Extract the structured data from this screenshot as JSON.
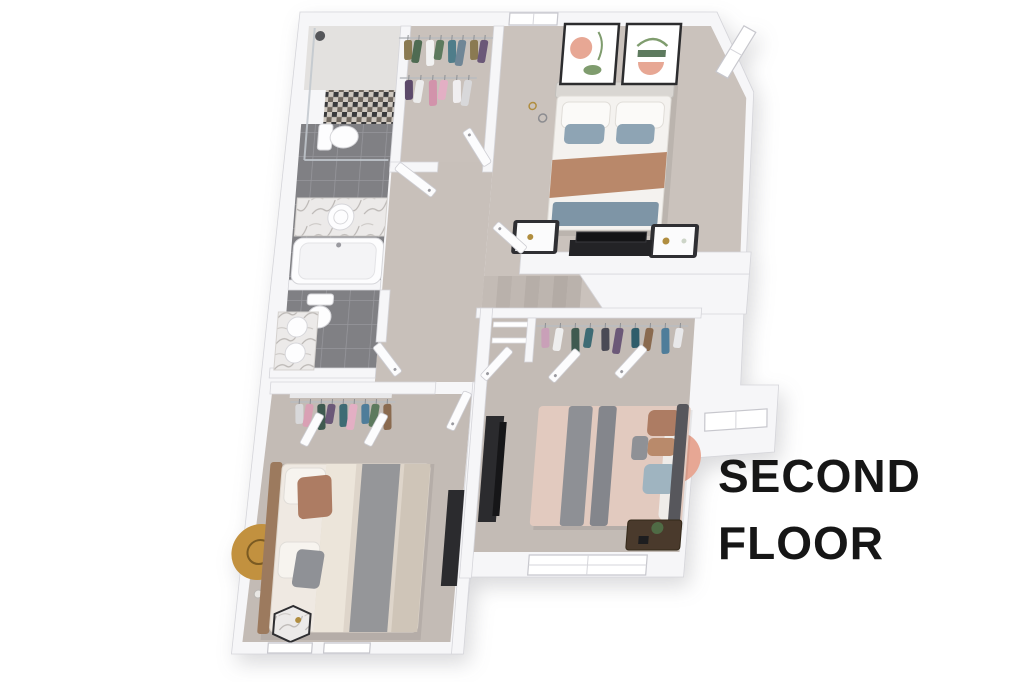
{
  "title": {
    "line1": "SECOND",
    "line2": "FLOOR",
    "color": "#161616"
  },
  "palette": {
    "background": "#ffffff",
    "wall": "#f6f6f8",
    "wall_edge": "#d5d5da",
    "carpet_master": "#cac2bc",
    "carpet_hall": "#c8c0ba",
    "carpet_bedroom": "#c3bbb5",
    "carpet_closet": "#c9c1bb",
    "tile_grey": "#808084",
    "mosaic_dark": "#39393b",
    "marble": "#eceae9",
    "dark_furniture": "#2b2b2e",
    "wood": "#4a3a2c",
    "gold": "#b08d3f",
    "rug_gold": "#c2913f",
    "rug_pink": "#e7a794",
    "rug_green": "#42594a",
    "bed_blue_pillow": "#8ea4b4",
    "bed_tan_throw": "#b9886a",
    "bed_slate_bench": "#7e95a6",
    "bed_pink_duvet": "#e2cabf",
    "bed_grey_throw": "#8e9095",
    "bed_brown_pillow": "#ad7c63",
    "headboard_grey": "#57575c"
  },
  "rooms": [
    {
      "id": "primary-bedroom",
      "contents": [
        "double-bed",
        "nightstand-left",
        "nightstand-right",
        "wall-art-1",
        "wall-art-2",
        "tv-on-half-wall",
        "pendant-lights"
      ],
      "windows": 2
    },
    {
      "id": "primary-walk-in-closet",
      "contents": [
        "clothes-rail-upper",
        "clothes-rail-lower"
      ]
    },
    {
      "id": "primary-bathroom",
      "contents": [
        "walk-in-shower",
        "toilet",
        "vanity-sink",
        "bathtub"
      ]
    },
    {
      "id": "second-bathroom",
      "contents": [
        "toilet",
        "double-vanity"
      ]
    },
    {
      "id": "hallway",
      "contents": [
        "staircase"
      ]
    },
    {
      "id": "middle-bedroom",
      "contents": [
        "double-bed",
        "tv-cabinet",
        "wood-nightstand-with-plant",
        "round-rug",
        "closet-with-shelves-and-rail"
      ],
      "windows": 2
    },
    {
      "id": "left-bedroom",
      "contents": [
        "double-bed",
        "hexagon-marble-side-table",
        "floor-lamp",
        "round-gold-rug",
        "media-unit",
        "closet-rail"
      ],
      "windows": 2
    }
  ],
  "closets": {
    "master_rail_1": {
      "colors": [
        "#8a7a52",
        "#4f6b52",
        "#f2f2f2",
        "#5d7a5e",
        "#4f7d8a",
        "#6f8696",
        "#8a7a52",
        "#6b5878"
      ],
      "x": 106,
      "y": 26,
      "gap": 11
    },
    "master_rail_2": {
      "colors": [
        "#5d4a6b",
        "#ececec",
        "#d293ab",
        "#e3afc4",
        "#f0eef0",
        "#d8d8da"
      ],
      "x": 110,
      "y": 66,
      "gap": 12
    },
    "middle": {
      "colors": [
        "#c9a0b8",
        "#eeeeee",
        "#3f5a50",
        "#3e6b74",
        "#4a4a55",
        "#6b5878",
        "#2f5d6b",
        "#8a6a4f",
        "#4f7d9a",
        "#e8e8ea"
      ],
      "x": 266,
      "y": 314,
      "gap": 15
    },
    "bedroom_left": {
      "colors": [
        "#d8d8da",
        "#d9a0b4",
        "#3f5a50",
        "#6b5878",
        "#3e6b74",
        "#e3afc4",
        "#4f7d9a",
        "#5d7a5e",
        "#8a6a4f"
      ],
      "x": 26,
      "y": 390,
      "gap": 11
    }
  }
}
